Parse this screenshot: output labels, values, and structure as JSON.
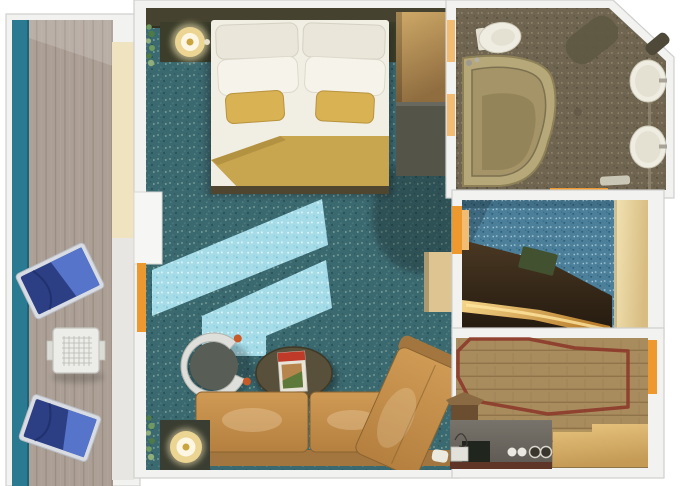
{
  "meta": {
    "canvas": {
      "width": 680,
      "height": 486
    },
    "subject": "cruise-suite-floorplan-render"
  },
  "palette": {
    "background": "#ffffff",
    "wall": "#f2f2f0",
    "wall_stroke": "#cfcfcd",
    "accent_orange": "#ee9930",
    "accent_orange_light": "#f2bd72",
    "balcony_rail_teal": "#2a7b91",
    "balcony_rail_edge": "#1f6378",
    "deck_wood": "#aca096",
    "deck_plank_line": "#9a8d82",
    "deck_wall_cream": "#f0e3c0",
    "deck_wall_gray": "#e7e6e3",
    "lounge_frame": "#d9dde3",
    "lounge_dark_blue": "#2c3f85",
    "lounge_light_blue": "#5777cd",
    "balcony_table": "#ecece8",
    "carpet_teal": "#3b6970",
    "sunlight_cyan": "#a5dce8",
    "headboard_wall": "#45422f",
    "nightstand": "#3c3e2b",
    "lamp_glow": "#ecd492",
    "lamp_center": "#fdf6e3",
    "lamp_ring": "#caa43e",
    "bed_white": "#f1eee4",
    "pillow_white": "#f6f3ea",
    "pillow_shade": "#eae7da",
    "pillow_gold": "#d9b254",
    "blanket_gold": "#c8a64f",
    "bed_bench": "#50452e",
    "wardrobe_tan_light": "#cfa968",
    "wardrobe_tan_dark": "#8f6d3f",
    "dresser_dark": "#555449",
    "cabinet_tan": "#dec490",
    "chair_shell": "#dededa",
    "chair_seat": "#585d55",
    "chair_knob": "#c85a28",
    "side_table_dark": "#3a3d31",
    "coffee_table_olive": "#58503a",
    "magazine_white": "#e8e4da",
    "magazine_red": "#c03a2a",
    "magazine_photo": "#b5854d",
    "magazine_leaf": "#5d7a3a",
    "sofa_light": "#cf9a54",
    "sofa_dark": "#b5803f",
    "sofa_back": "#a2763e",
    "sofa_seam": "#8a6330",
    "bath_floor": "#6f6550",
    "tub_rim": "#b7a87a",
    "tub_inner": "#a59467",
    "tub_floor": "#948459",
    "porcelain": "#efede2",
    "porcelain_inner": "#e4e1d2",
    "bath_mat": "#5e5843",
    "bath_shelf": "#4e4938",
    "dressing_carpet": "#4b7f9a",
    "counter_brown": "#4a3823",
    "counter_brown_dark": "#241a0f",
    "counter_gold_light": "#f6d68a",
    "counter_gold_dark": "#b97f2e",
    "counter_gold_core": "#ffe6a0",
    "wardrobe_cream_light": "#f2e4b4",
    "wardrobe_cream_dark": "#d8bc82",
    "green_item": "#42512f",
    "wood_floor": "#a98c5e",
    "rug_border_red": "#8c3a2a",
    "cabinet_gold_light": "#e7c47e",
    "cabinet_gold_dark": "#c49a55",
    "bar_counter_gray": "#78746c",
    "bar_counter_gray_dark": "#5f5b54",
    "bar_front_brown": "#5e3526",
    "bar_item_dark": "#20261e",
    "bar_item_white": "#e3e2da",
    "pedestal_brown": "#6b4e30",
    "pedestal_top": "#8a6a42",
    "plant_green_a": "#6f9a5e",
    "plant_green_b": "#4e7a46",
    "plant_green_c": "#8fae79"
  }
}
